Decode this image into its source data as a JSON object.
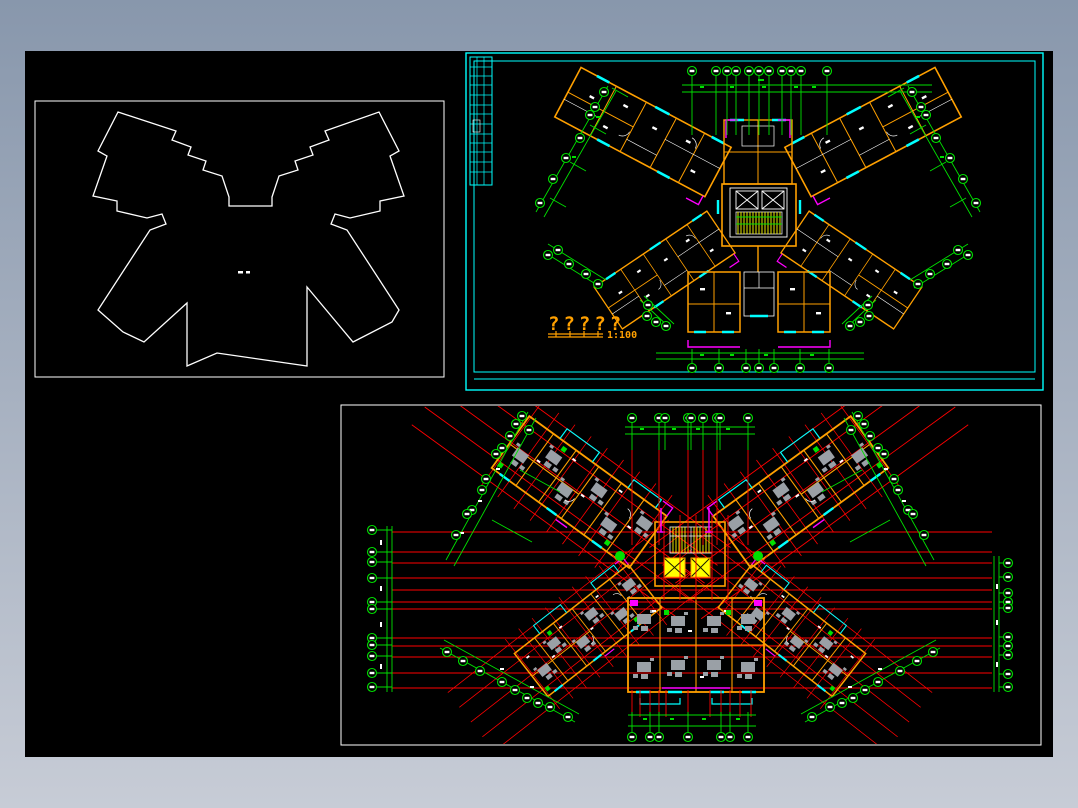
{
  "title_block": {
    "title": "?????",
    "scale": "1:100"
  },
  "colors": {
    "g": "#00e000",
    "r": "#ff0000",
    "c": "#00ffff",
    "m": "#ff00ff",
    "o": "#ffa000",
    "w": "#ffffff",
    "y": "#ffff00",
    "gy": "#9aa0a6",
    "frame1": "#8897ac",
    "frame2": "#c7ccd6",
    "cv": "#000000"
  },
  "icons": {
    "grid_bubble": "circle-axis-marker",
    "elevator": "box-with-x",
    "stair": "hatched-block"
  }
}
